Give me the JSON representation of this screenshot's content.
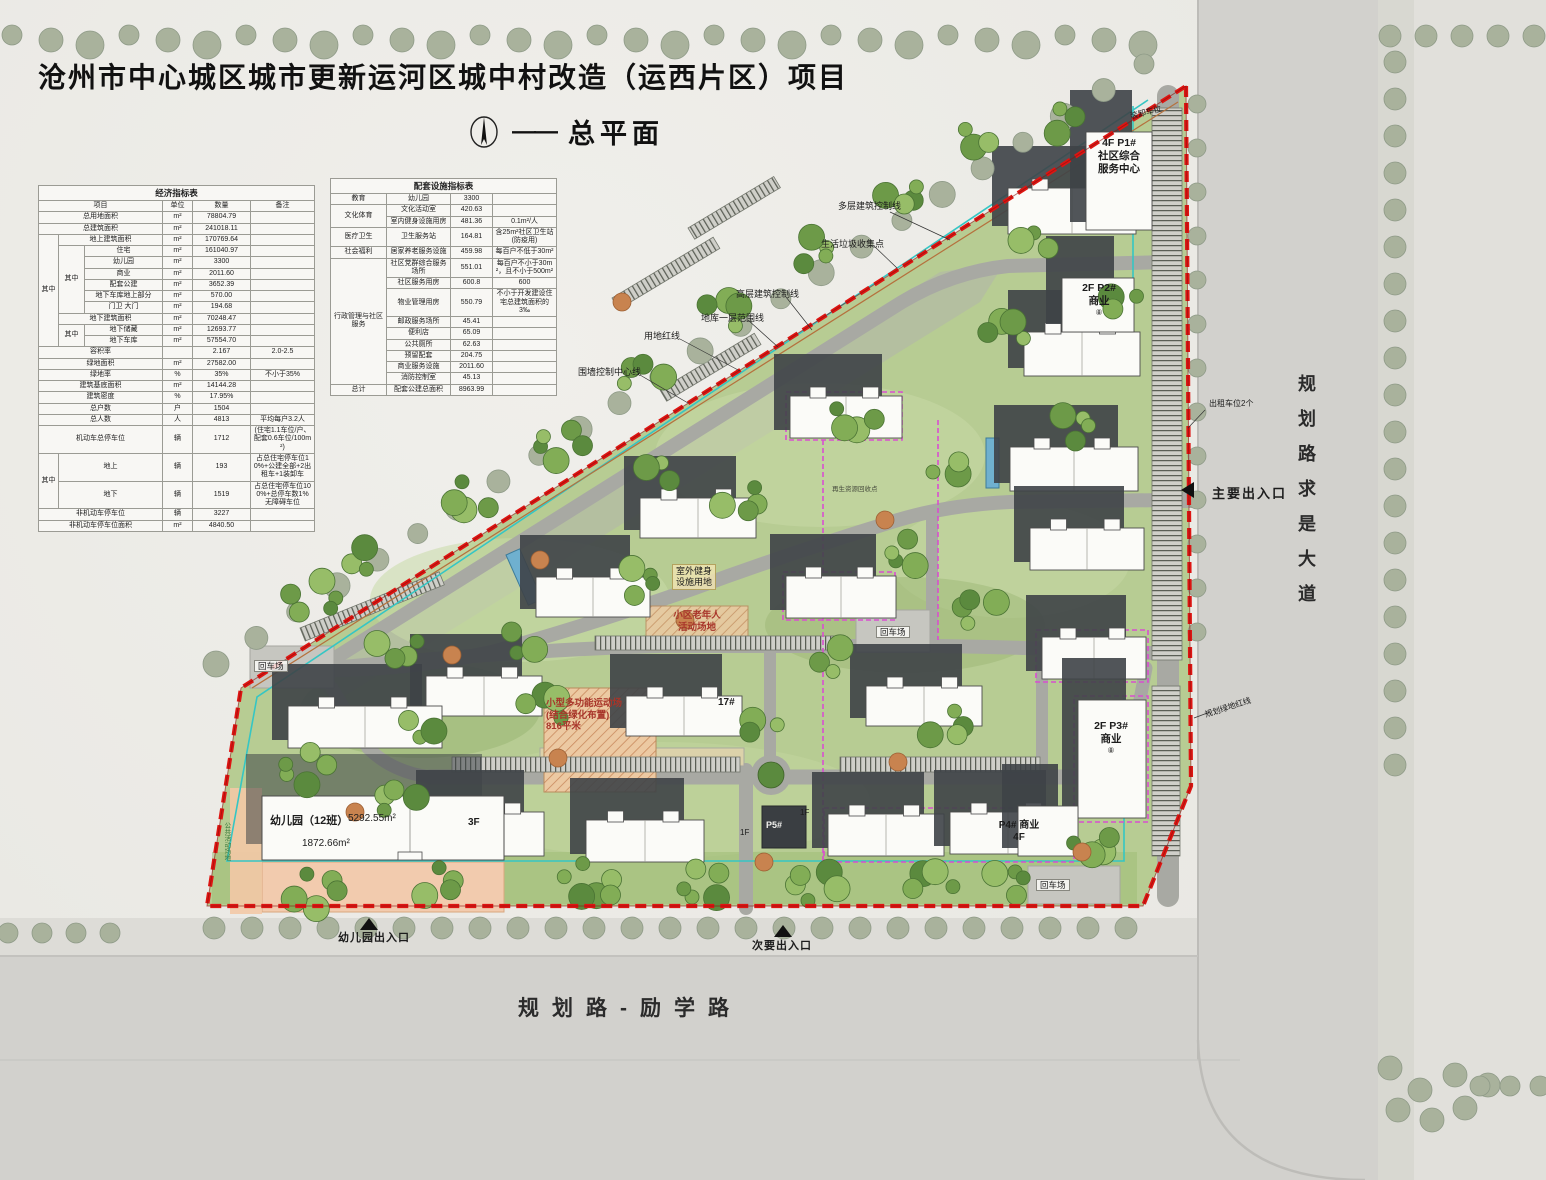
{
  "header": {
    "title": "沧州市中心城区城市更新运河区城中村改造（运西片区）项目",
    "subtitle": "总平面",
    "dash": "——",
    "north_icon": "north-arrow"
  },
  "tables": {
    "economic": {
      "title": "经济指标表",
      "rows": [
        [
          {
            "t": "项目",
            "cs": 3
          },
          {
            "t": "单位"
          },
          {
            "t": "数量"
          },
          {
            "t": "备注"
          }
        ],
        [
          {
            "t": "总用地面积",
            "cs": 3
          },
          {
            "t": "m²"
          },
          {
            "t": "78804.79"
          },
          {
            "t": ""
          }
        ],
        [
          {
            "t": "总建筑面积",
            "cs": 3
          },
          {
            "t": "m²"
          },
          {
            "t": "241018.11"
          },
          {
            "t": ""
          }
        ],
        [
          {
            "t": "其中",
            "rs": 10
          },
          {
            "t": "地上建筑面积",
            "cs": 2
          },
          {
            "t": "m²"
          },
          {
            "t": "170769.64"
          },
          {
            "t": ""
          }
        ],
        [
          {
            "t": "其中",
            "rs": 6
          },
          {
            "t": "住宅"
          },
          {
            "t": "m²"
          },
          {
            "t": "161040.97"
          },
          {
            "t": ""
          }
        ],
        [
          {
            "t": "幼儿园"
          },
          {
            "t": "m²"
          },
          {
            "t": "3300"
          },
          {
            "t": ""
          }
        ],
        [
          {
            "t": "商业"
          },
          {
            "t": "m²"
          },
          {
            "t": "2011.60"
          },
          {
            "t": ""
          }
        ],
        [
          {
            "t": "配套公建"
          },
          {
            "t": "m²"
          },
          {
            "t": "3652.39"
          },
          {
            "t": ""
          }
        ],
        [
          {
            "t": "地下车库地上部分"
          },
          {
            "t": "m²"
          },
          {
            "t": "570.00"
          },
          {
            "t": ""
          }
        ],
        [
          {
            "t": "门卫 大门"
          },
          {
            "t": "m²"
          },
          {
            "t": "194.68"
          },
          {
            "t": ""
          }
        ],
        [
          {
            "t": "地下建筑面积",
            "cs": 2
          },
          {
            "t": "m²"
          },
          {
            "t": "70248.47"
          },
          {
            "t": ""
          }
        ],
        [
          {
            "t": "其中",
            "rs": 2
          },
          {
            "t": "地下储藏"
          },
          {
            "t": "m²"
          },
          {
            "t": "12693.77"
          },
          {
            "t": ""
          }
        ],
        [
          {
            "t": "地下车库"
          },
          {
            "t": "m²"
          },
          {
            "t": "57554.70"
          },
          {
            "t": ""
          }
        ],
        [
          {
            "t": "容积率",
            "cs": 3
          },
          {
            "t": ""
          },
          {
            "t": "2.167"
          },
          {
            "t": "2.0-2.5"
          }
        ],
        [
          {
            "t": "绿地面积",
            "cs": 3
          },
          {
            "t": "m²"
          },
          {
            "t": "27582.00"
          },
          {
            "t": ""
          }
        ],
        [
          {
            "t": "绿地率",
            "cs": 3
          },
          {
            "t": "%"
          },
          {
            "t": "35%"
          },
          {
            "t": "不小于35%"
          }
        ],
        [
          {
            "t": "建筑基底面积",
            "cs": 3
          },
          {
            "t": "m²"
          },
          {
            "t": "14144.28"
          },
          {
            "t": ""
          }
        ],
        [
          {
            "t": "建筑密度",
            "cs": 3
          },
          {
            "t": "%"
          },
          {
            "t": "17.95%"
          },
          {
            "t": ""
          }
        ],
        [
          {
            "t": "总户数",
            "cs": 3
          },
          {
            "t": "户"
          },
          {
            "t": "1504"
          },
          {
            "t": ""
          }
        ],
        [
          {
            "t": "总人数",
            "cs": 3
          },
          {
            "t": "人"
          },
          {
            "t": "4813"
          },
          {
            "t": "平均每户3.2人"
          }
        ],
        [
          {
            "t": "机动车总停车位",
            "cs": 3
          },
          {
            "t": "辆"
          },
          {
            "t": "1712"
          },
          {
            "t": "(住宅1.1车位/户、配套0.6车位/100m²)"
          }
        ],
        [
          {
            "t": "其中",
            "rs": 2
          },
          {
            "t": "地上",
            "cs": 2
          },
          {
            "t": "辆"
          },
          {
            "t": "193"
          },
          {
            "t": "占总住宅停车位10%+公建全部+2出租车+1装卸车"
          }
        ],
        [
          {
            "t": "地下",
            "cs": 2
          },
          {
            "t": "辆"
          },
          {
            "t": "1519"
          },
          {
            "t": "占总住宅停车位100%+总停车数1%无障碍车位"
          }
        ],
        [
          {
            "t": "非机动车停车位",
            "cs": 3
          },
          {
            "t": "辆"
          },
          {
            "t": "3227"
          },
          {
            "t": ""
          }
        ],
        [
          {
            "t": "非机动车停车位面积",
            "cs": 3
          },
          {
            "t": "m²"
          },
          {
            "t": "4840.50"
          },
          {
            "t": ""
          }
        ]
      ]
    },
    "facilities": {
      "title": "配套设施指标表",
      "rows": [
        [
          {
            "t": "教育"
          },
          {
            "t": "幼儿园"
          },
          {
            "t": "3300"
          },
          {
            "t": ""
          }
        ],
        [
          {
            "t": "文化体育",
            "rs": 2
          },
          {
            "t": "文化活动室"
          },
          {
            "t": "420.63"
          },
          {
            "t": ""
          }
        ],
        [
          {
            "t": "室内健身设施用房"
          },
          {
            "t": "481.36"
          },
          {
            "t": "0.1m²/人"
          }
        ],
        [
          {
            "t": "医疗卫生"
          },
          {
            "t": "卫生服务站"
          },
          {
            "t": "164.81"
          },
          {
            "t": "含25m²社区卫生站(防疫用)"
          }
        ],
        [
          {
            "t": "社会福利"
          },
          {
            "t": "居家养老服务设施"
          },
          {
            "t": "459.98"
          },
          {
            "t": "每百户不低于30m²"
          }
        ],
        [
          {
            "t": "行政管理与社区服务",
            "rs": 9
          },
          {
            "t": "社区党群综合服务场所"
          },
          {
            "t": "551.01"
          },
          {
            "t": "每百户不小于30m²，且不小于500m²"
          }
        ],
        [
          {
            "t": "社区服务用房"
          },
          {
            "t": "600.8"
          },
          {
            "t": "600"
          }
        ],
        [
          {
            "t": "物业管理用房"
          },
          {
            "t": "550.79"
          },
          {
            "t": "不小于开发建设住宅总建筑面积的3‰"
          }
        ],
        [
          {
            "t": "邮政服务场所"
          },
          {
            "t": "45.41"
          },
          {
            "t": ""
          }
        ],
        [
          {
            "t": "便利店"
          },
          {
            "t": "65.09"
          },
          {
            "t": ""
          }
        ],
        [
          {
            "t": "公共厕所"
          },
          {
            "t": "62.63"
          },
          {
            "t": ""
          }
        ],
        [
          {
            "t": "预留配套"
          },
          {
            "t": "204.75"
          },
          {
            "t": ""
          }
        ],
        [
          {
            "t": "商业服务设施"
          },
          {
            "t": "2011.60"
          },
          {
            "t": ""
          }
        ],
        [
          {
            "t": "消防控制室"
          },
          {
            "t": "45.13"
          },
          {
            "t": ""
          }
        ],
        [
          {
            "t": "总计"
          },
          {
            "t": "配套公建总面积"
          },
          {
            "t": "8963.99"
          },
          {
            "t": ""
          }
        ]
      ]
    }
  },
  "plan": {
    "loading_bay": "装卸车位",
    "p1_l1": "4F  P1#",
    "p1_l2": "社区综合",
    "p1_l3": "服务中心",
    "ctrl_multi": "多层建筑控制线",
    "waste_point": "生活垃圾收集点",
    "ctrl_high": "高层建筑控制线",
    "basement_line": "地库一层范围线",
    "site_redline": "用地红线",
    "wall_line": "围墙控制中心线",
    "p2_l1": "2F  P2#",
    "p2_l2": "商业",
    "unit_mark": "⑧",
    "taxi": "出租车位2个",
    "main_entrance": "主要出入口",
    "green_redline": "规划绿地红线",
    "turnaround": "回车场",
    "fitness_l1": "室外健身",
    "fitness_l2": "设施用地",
    "elderly_l1": "小区老年人",
    "elderly_l2": "活动场地",
    "sport_l1": "小型多功能运动场",
    "sport_l2": "(结合绿化布置)",
    "sport_l3": "816平米",
    "b17": "17#",
    "p3_l1": "2F  P3#",
    "p3_l2": "商业",
    "p4_l1": "P4# 商业",
    "p4_l2": "4F",
    "p5": "P5#",
    "f1": "1F",
    "kg_name": "幼儿园（12班）",
    "kg_area1": "5292.55m²",
    "kg_floors": "3F",
    "kg_area2": "1872.66m²",
    "public_activity": "公共活动场地",
    "recycle_point": "再生资源回收点",
    "kg_entrance": "幼儿园出入口",
    "secondary_entrance": "次要出入口"
  },
  "roads": {
    "bottom": "规划路-励学路",
    "right": "规划路求是大道"
  },
  "colors": {
    "boundary_red": "#de1512",
    "basement_cyan": "#35c6c4",
    "highrise_magenta": "#d94fd0",
    "wall_brown": "#b5713d",
    "grass": "#b7cc93",
    "asphalt": "#a8a9a3",
    "outer_road": "#d2d1cd",
    "building_white": "#fbfbf8",
    "shadow_gray": "#3e4347"
  }
}
